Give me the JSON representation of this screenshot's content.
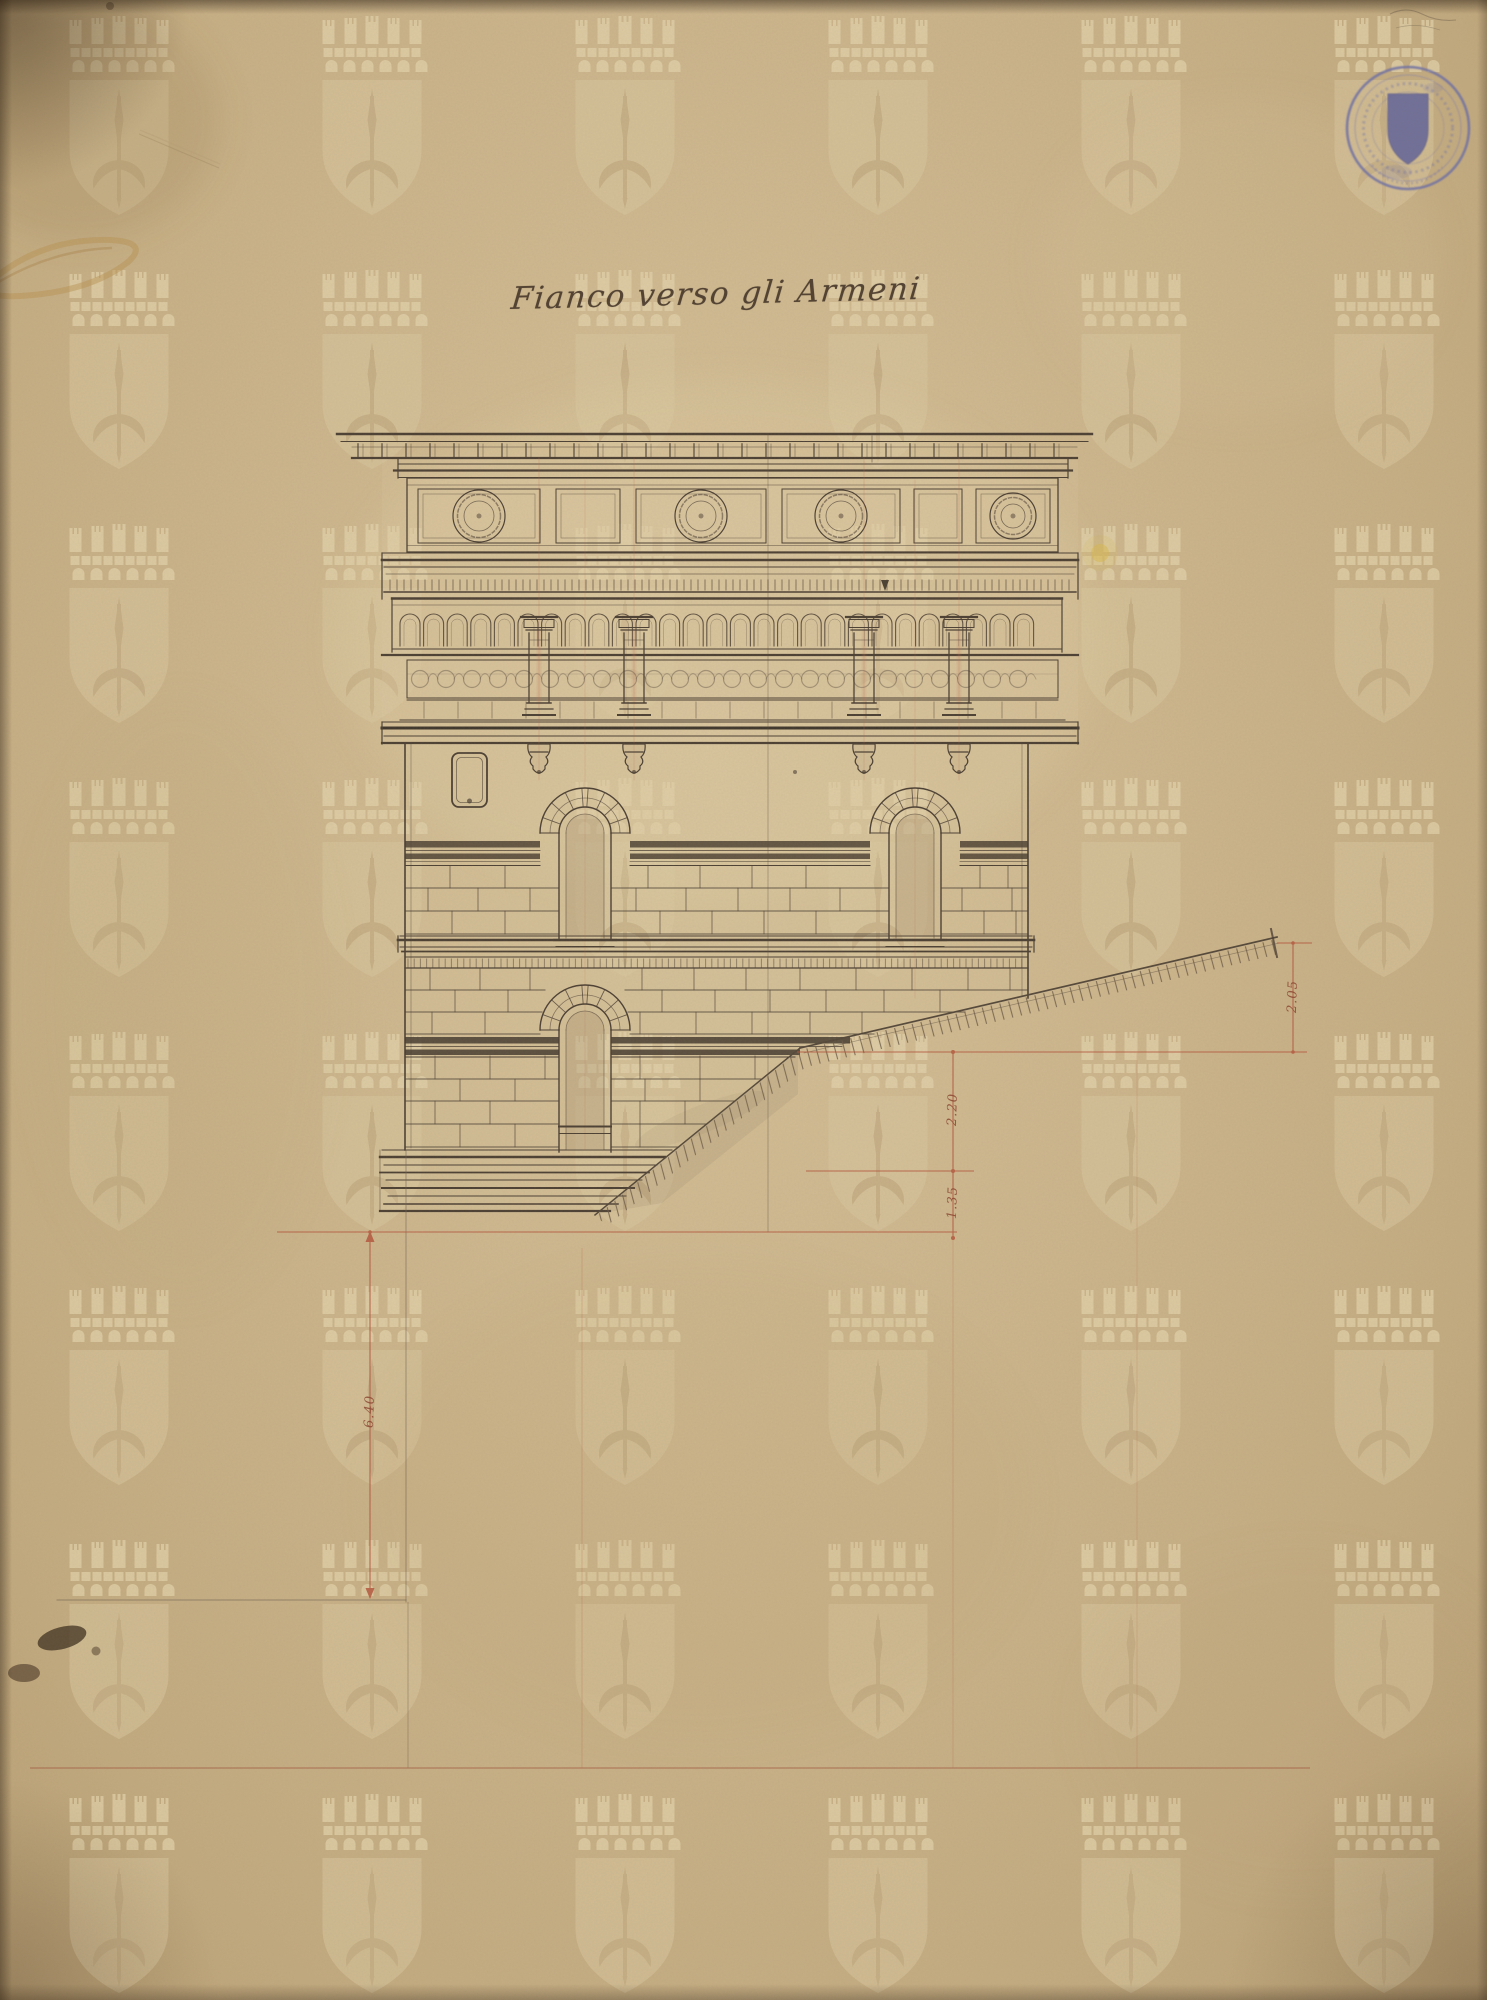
{
  "sheet": {
    "title": "Fianco verso gli Armeni"
  },
  "dimensions": [
    {
      "id": "slope-height-upper-right",
      "value": "2.05"
    },
    {
      "id": "terrace-height-middle",
      "value": "2.20"
    },
    {
      "id": "step-height-middle",
      "value": "1.35"
    },
    {
      "id": "height-left",
      "value": "6.40"
    }
  ],
  "icons": {
    "stamp": "circular-archive-seal-with-heraldic-shield",
    "watermark": "mural-crown-over-halberd-shield"
  },
  "colors": {
    "paper": "#cdb68d",
    "ink": "#4c4034",
    "red_line": "#b5573d",
    "stamp_ink": "#61639f",
    "watermark": "#ddcba3"
  }
}
